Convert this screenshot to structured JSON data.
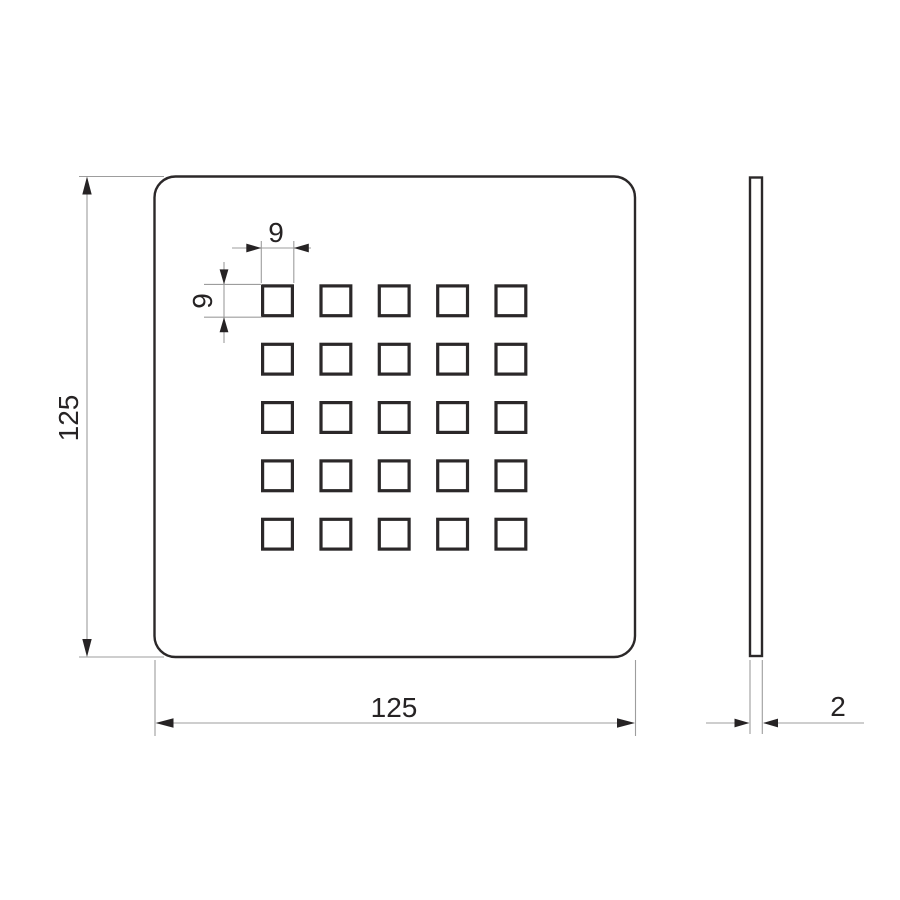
{
  "colors": {
    "background": "#ffffff",
    "outline": "#2b2829",
    "dimension_line": "#9d9d9d",
    "text": "#262324"
  },
  "front_view": {
    "grid_rows": 5,
    "grid_cols": 5
  },
  "dimensions": {
    "plate_width": "125",
    "plate_height": "125",
    "hole_width": "9",
    "hole_height": "9",
    "thickness": "2"
  }
}
